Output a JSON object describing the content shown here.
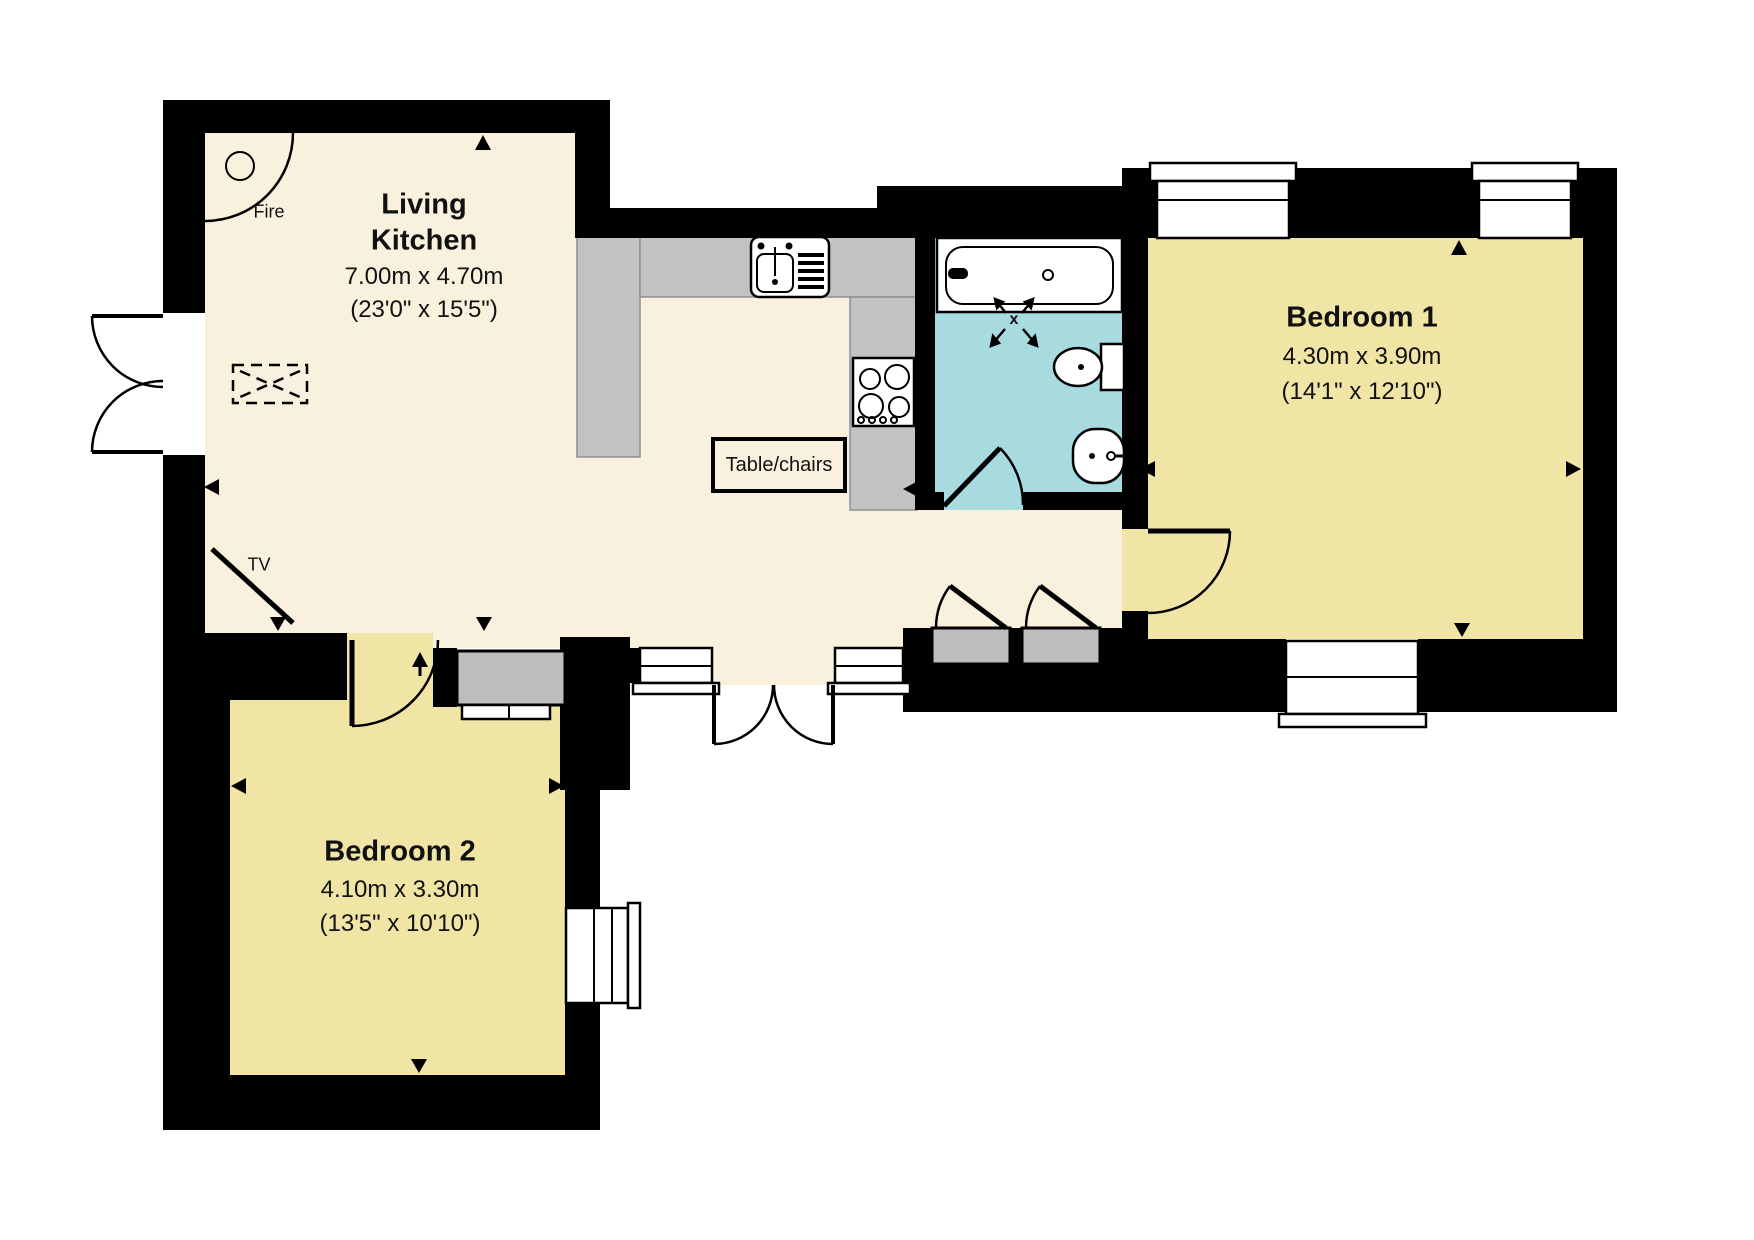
{
  "plan": {
    "rooms": {
      "living_kitchen": {
        "name_line1": "Living",
        "name_line2": "Kitchen",
        "dims_metric": "7.00m x 4.70m",
        "dims_imperial": "(23'0\" x 15'5\")"
      },
      "bedroom_1": {
        "name": "Bedroom 1",
        "dims_metric": "4.30m x 3.90m",
        "dims_imperial": "(14'1\" x 12'10\")"
      },
      "bedroom_2": {
        "name": "Bedroom 2",
        "dims_metric": "4.10m x 3.30m",
        "dims_imperial": "(13'5\" x 10'10\")"
      }
    },
    "annotations": {
      "fire": "Fire",
      "tv": "TV",
      "table_chairs": "Table/chairs",
      "shower_mark": "x"
    },
    "colors": {
      "floor_cream": "#FAF0DE",
      "bedroom_yellow": "#F0E5A4",
      "bathroom_cyan": "#A7DBE0",
      "counter_gray": "#C2C2C2",
      "cupboard_gray": "#BDBDBD",
      "wall_black": "#000000",
      "background": "#FFFFFF"
    }
  }
}
